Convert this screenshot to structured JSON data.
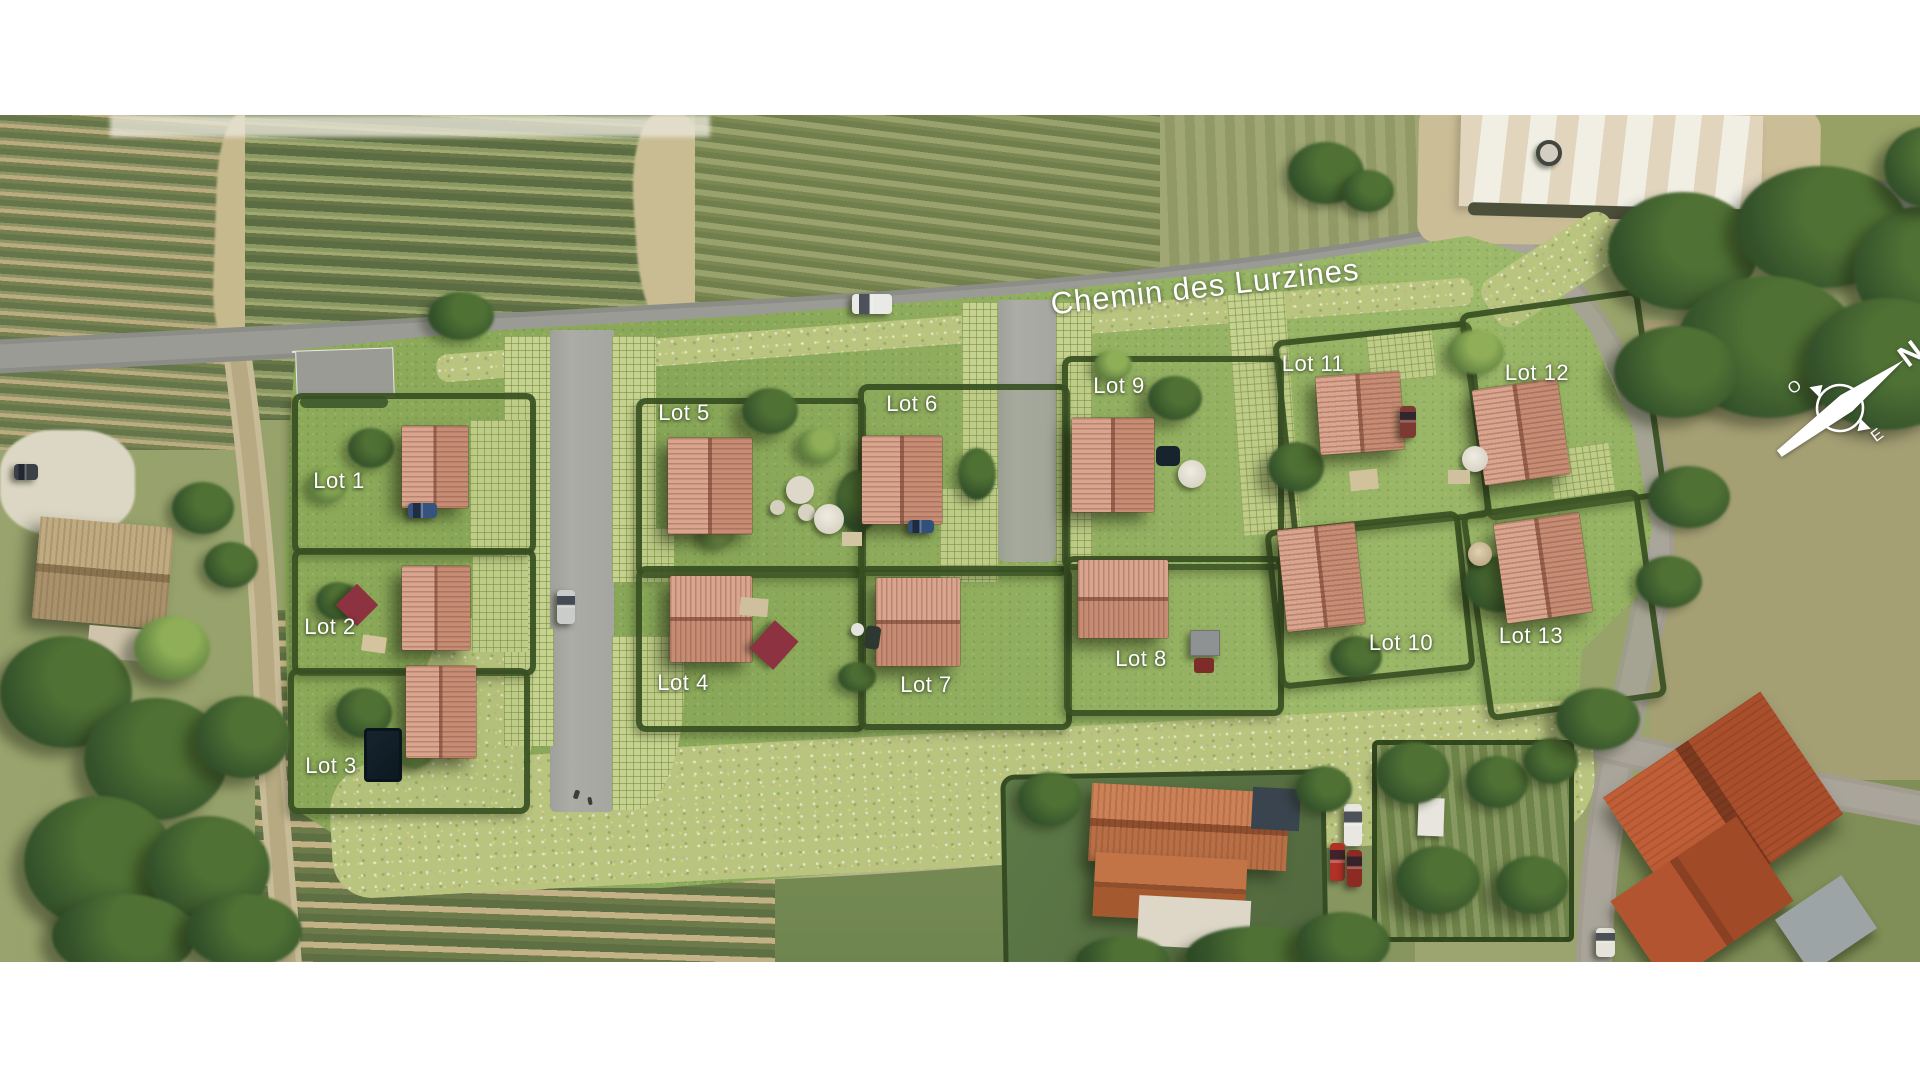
{
  "street": {
    "name": "Chemin des Lurzines"
  },
  "compass": {
    "north": "N",
    "west": "O",
    "east": "E"
  },
  "lots": [
    {
      "id": 1,
      "label": "Lot 1"
    },
    {
      "id": 2,
      "label": "Lot 2"
    },
    {
      "id": 3,
      "label": "Lot 3"
    },
    {
      "id": 4,
      "label": "Lot 4"
    },
    {
      "id": 5,
      "label": "Lot 5"
    },
    {
      "id": 6,
      "label": "Lot 6"
    },
    {
      "id": 7,
      "label": "Lot 7"
    },
    {
      "id": 8,
      "label": "Lot 8"
    },
    {
      "id": 9,
      "label": "Lot 9"
    },
    {
      "id": 10,
      "label": "Lot 10"
    },
    {
      "id": 11,
      "label": "Lot 11"
    },
    {
      "id": 12,
      "label": "Lot 12"
    },
    {
      "id": 13,
      "label": "Lot 13"
    }
  ],
  "palette": {
    "site_lawn": "#8fae5a",
    "meadow": "#b9c47f",
    "hedge_green": "#374f23",
    "road_asphalt": "#8c8d86",
    "internal_road": "#a5a6a0",
    "grass_paver": "#c6d28f",
    "new_roof_terracotta": "#c68c74",
    "existing_roof_orange": "#b05330",
    "label_text": "#ffffff"
  }
}
